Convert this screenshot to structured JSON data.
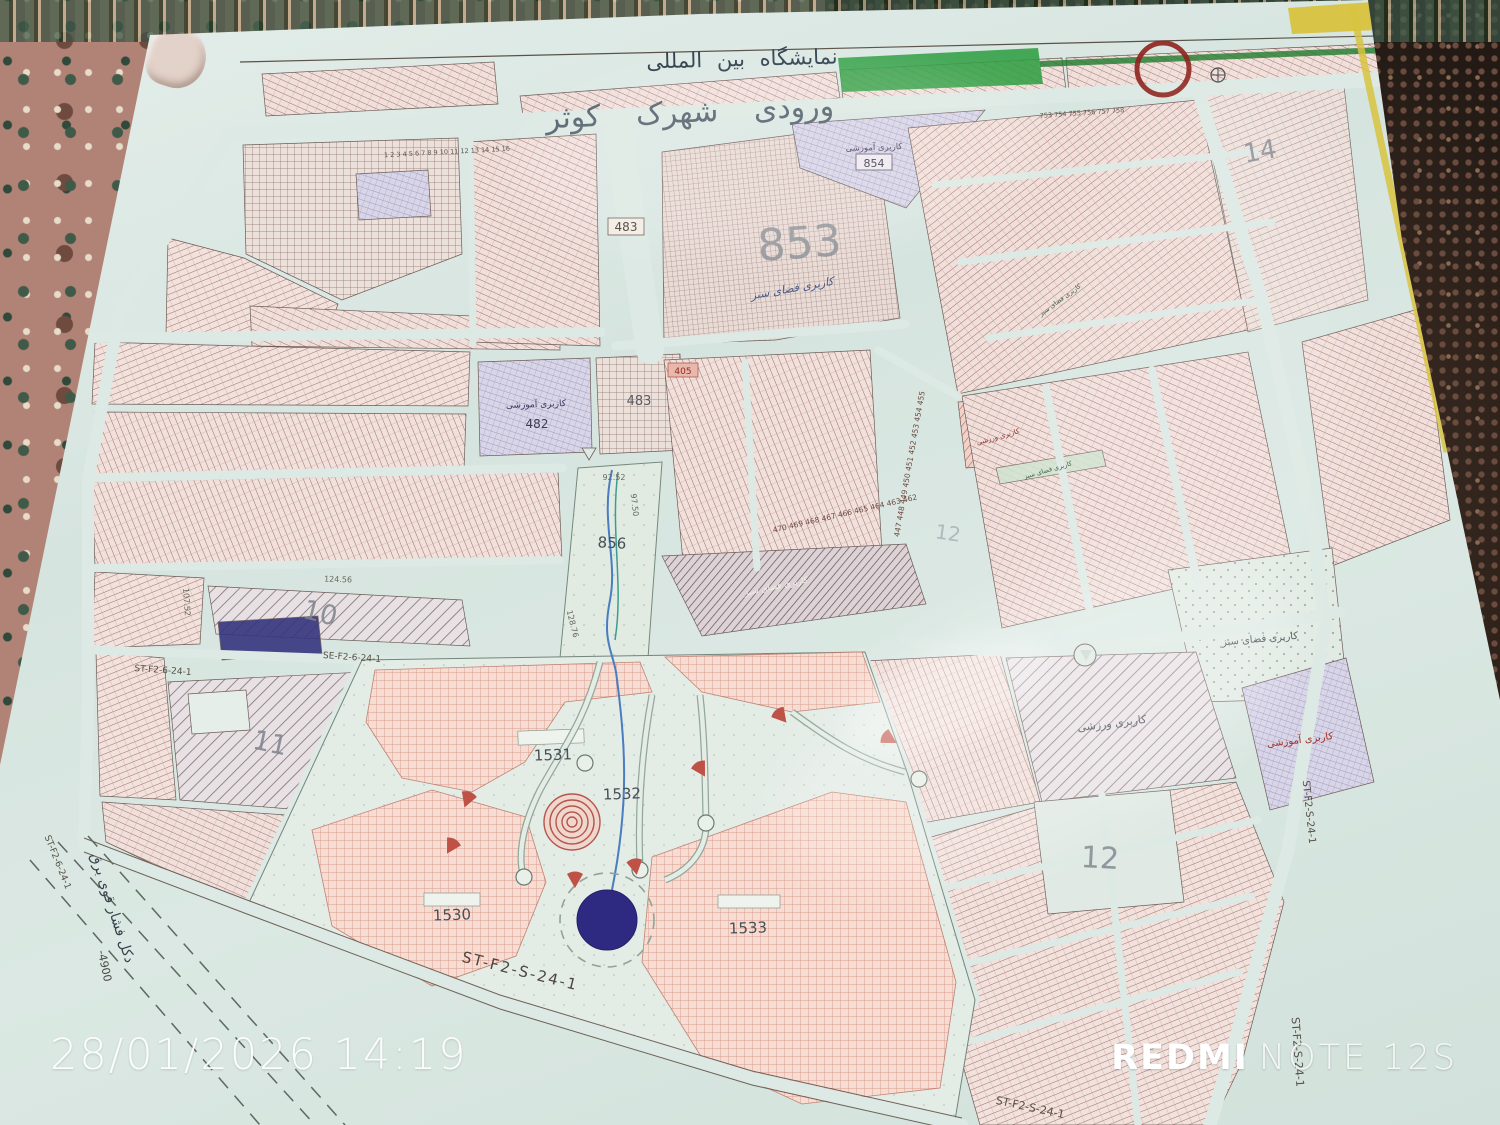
{
  "photo_overlay": {
    "timestamp": "28/01/2026 14:19",
    "brand": "REDMI",
    "model": "NOTE 12S"
  },
  "map": {
    "title": "نمایشگاه بین المللی",
    "entrance": "ورودی شهرک کوثر",
    "landuse": {
      "education": "کاربری آموزشی",
      "sports": "کاربری ورزشی",
      "green": "کاربری فضای سبز"
    },
    "zones": {
      "z853": "853",
      "z854": "854",
      "z856": "856",
      "z482": "482",
      "z483": "483",
      "z405": "405",
      "z10": "10",
      "z11": "11",
      "z12": "12",
      "z14": "14",
      "z1530": "1530",
      "z1531": "1531",
      "z1532": "1532",
      "z1533": "1533"
    },
    "streets": {
      "st_s24": "ST-F2-S-24-1",
      "st_6_24": "ST-F2-6-24-1",
      "se_6_24": "SE-F2-6-24-1"
    },
    "annotations": {
      "power_line": "دکل فشار قوی برق",
      "elevation": "-4900"
    },
    "measurements": {
      "m1": "92.52",
      "m2": "97.50",
      "m3": "124.56",
      "m4": "107.52",
      "m5": "128.76"
    },
    "parcel_numbers": {
      "row_diag": "470 469 468 467 466 465 464 463 462",
      "col_right": "447 448 449 450 451 452 453 454 455",
      "row_top": "753 754 755 756 757 758",
      "row_strip": "1 2 3 4 5 6 7 8 9 10 11 12 13 14 15 16"
    }
  }
}
